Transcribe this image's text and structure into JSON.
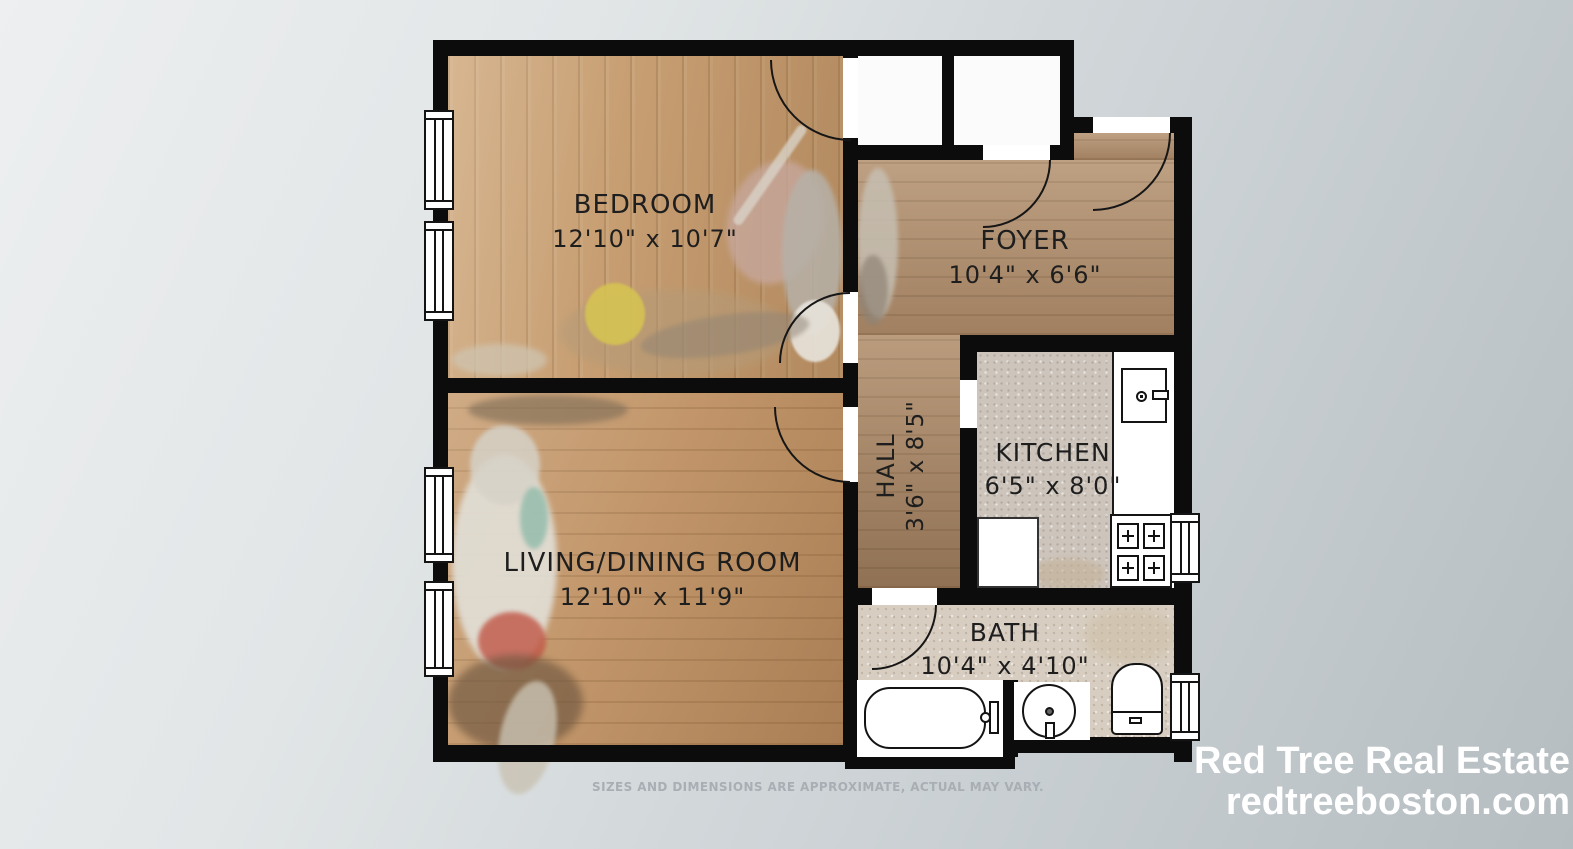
{
  "branding": {
    "company": "Red Tree Real Estate",
    "website": "redtreeboston.com",
    "text_color": "#ffffff"
  },
  "disclaimer": "SIZES AND DIMENSIONS ARE APPROXIMATE, ACTUAL MAY VARY.",
  "rooms": [
    {
      "name": "BEDROOM",
      "dimensions": "12'10\" x 10'7\""
    },
    {
      "name": "FOYER",
      "dimensions": "10'4\" x 6'6\""
    },
    {
      "name": "HALL",
      "dimensions": "3'6\" x 8'5\""
    },
    {
      "name": "KITCHEN",
      "dimensions": "6'5\" x 8'0\""
    },
    {
      "name": "LIVING/DINING ROOM",
      "dimensions": "12'10\" x 11'9\""
    },
    {
      "name": "BATH",
      "dimensions": "10'4\" x 4'10\""
    }
  ],
  "colors": {
    "wall": "#0c0c0c",
    "wood_bedroom": "#c79e72",
    "wood_foyer_hall": "#b39170",
    "wood_living": "#c2966a",
    "tile_kitchen": "#cdc5bc",
    "tile_bath": "#d7cdc0",
    "background_start": "#edeff0",
    "background_end": "#b5bdc1",
    "disclaimer_text": "#a8aeb4"
  }
}
